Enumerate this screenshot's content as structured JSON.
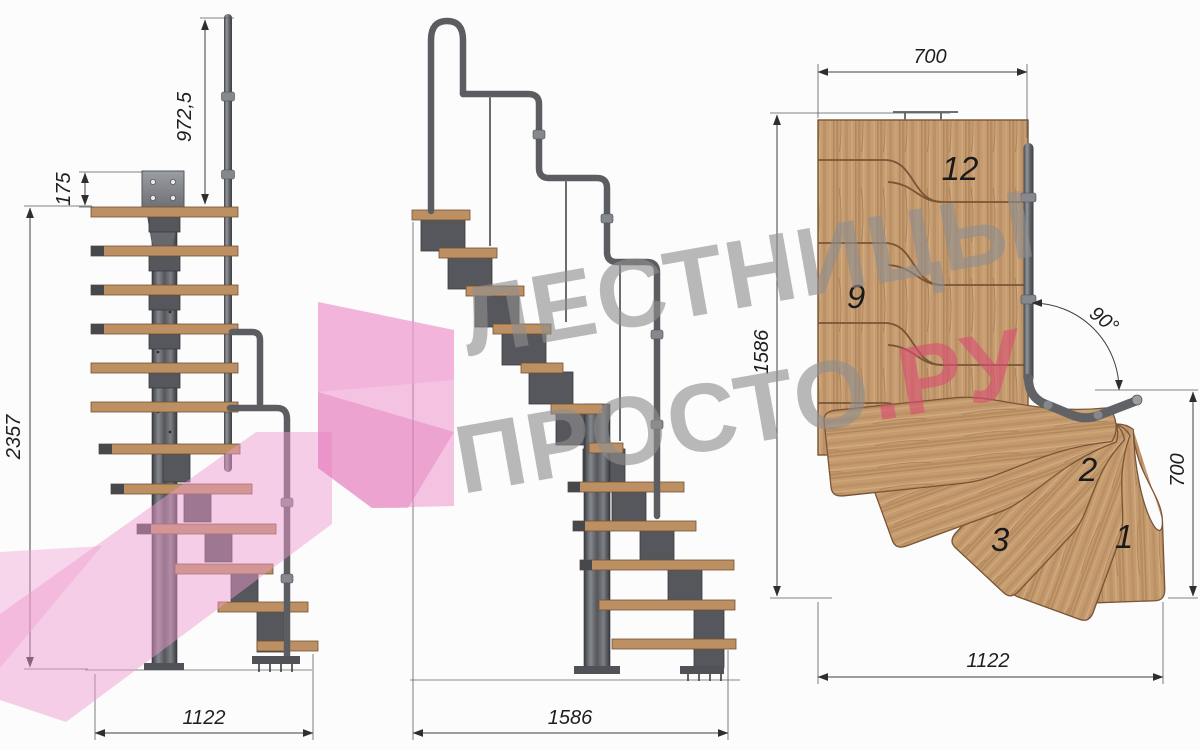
{
  "front_view": {
    "rail_height": "972,5",
    "plate_depth": "175",
    "total_height": "2357",
    "width": "1122"
  },
  "side_view": {
    "length": "1586"
  },
  "plan_view": {
    "top_width": "700",
    "depth": "1586",
    "turn_angle": "90°",
    "right_depth": "700",
    "bottom_width": "1122",
    "treads": {
      "t12": "12",
      "t9": "9",
      "t3": "3",
      "t2": "2",
      "t1": "1"
    }
  },
  "watermark": {
    "line1": "ЛЕСТНИЦЫ",
    "line2_gray": "ПРОСТО",
    "line2_pink": ".РУ"
  },
  "colors": {
    "wood": "#c59c72",
    "wood_outline": "#7a5535",
    "metal": "#55575c",
    "dimension": "#3f3f3f",
    "watermark_gray": "#8f8f8f",
    "watermark_pink": "#d94f72",
    "arrow_pink": "#ee8ac7",
    "background": "#fcfcfd"
  }
}
